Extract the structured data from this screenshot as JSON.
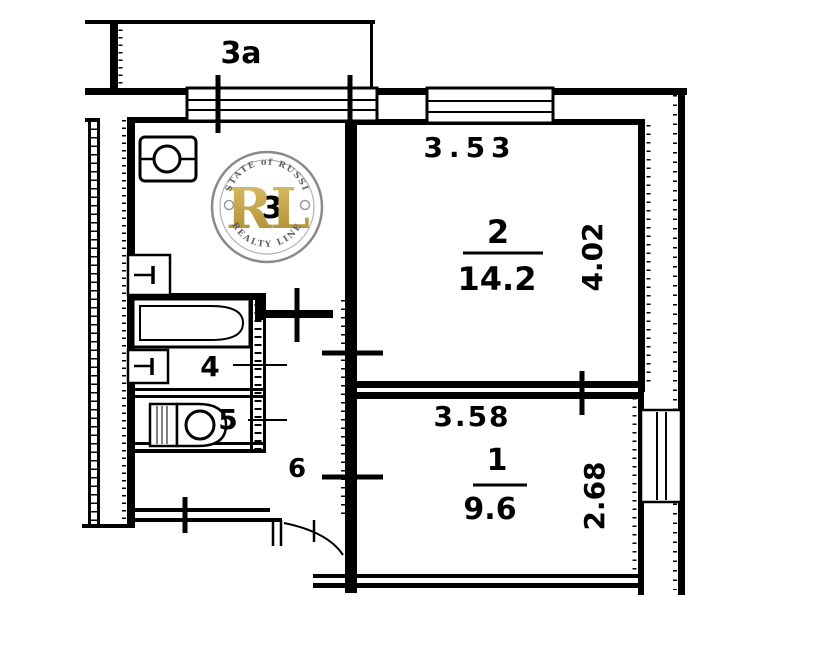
{
  "balcony": {
    "label": "3a"
  },
  "rooms": {
    "living": {
      "number": "2",
      "area": "14.2",
      "width": "3.53",
      "height": "4.02"
    },
    "bedroom": {
      "number": "1",
      "area": "9.6",
      "width": "3.58",
      "height": "2.68"
    },
    "kitchen": {
      "number": "3"
    },
    "bathroom": {
      "number": "4"
    },
    "toilet": {
      "number": "5"
    },
    "hallway": {
      "number": "6"
    }
  },
  "watermark": {
    "monogram": "RL",
    "arc_top": "ESTATE of RUSSIA",
    "arc_bottom": "REALTY LINE",
    "gold_light": "#dcc06a",
    "gold_dark": "#ab8a2e",
    "ring_color": "#8a8a8a"
  },
  "colors": {
    "ink": "#000000",
    "background": "#ffffff"
  }
}
